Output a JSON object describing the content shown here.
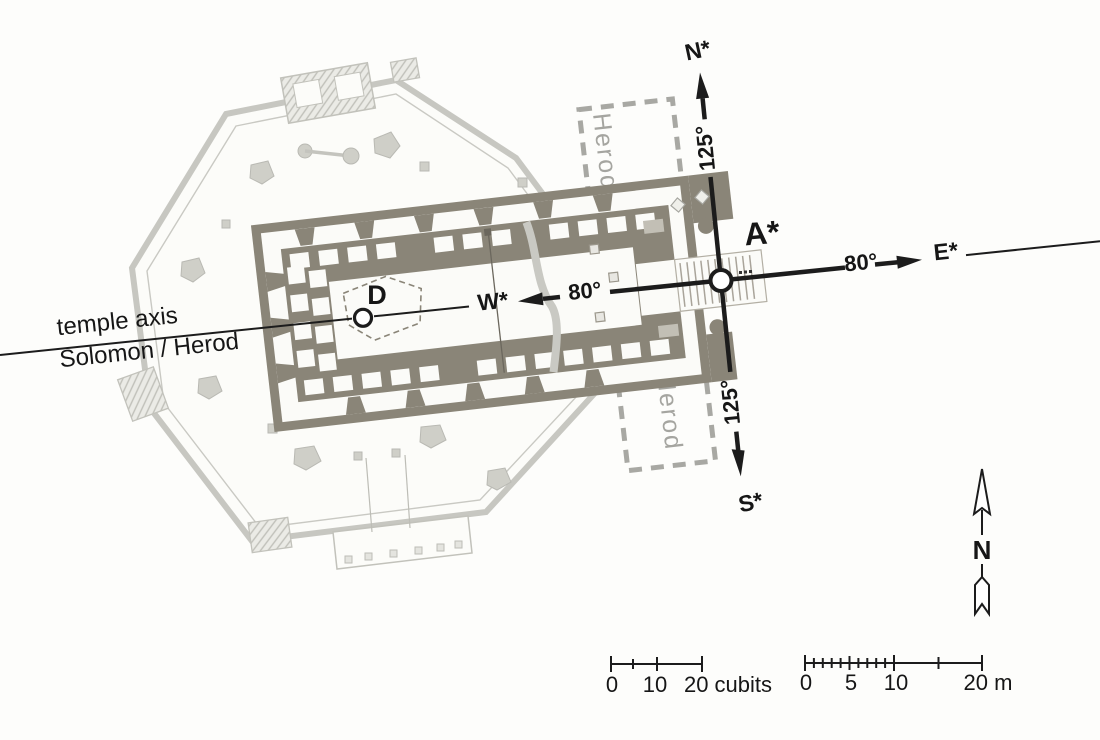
{
  "figure": {
    "axis": {
      "line1": "temple axis",
      "line2": "Solomon / Herod"
    },
    "points": {
      "a": "A*",
      "d": "D"
    },
    "compass": {
      "n": "N*",
      "s": "S*",
      "e": "E*",
      "w": "W*",
      "angle_n": "125°",
      "angle_s": "125°",
      "angle_e": "80°",
      "angle_w": "80°"
    },
    "herod": {
      "upper": "Herod",
      "lower": "Herod"
    },
    "north_indicator": {
      "label": "N"
    },
    "scale_cubits": {
      "t0": "0",
      "t10": "10",
      "t20": "20 cubits"
    },
    "scale_meters": {
      "t0": "0",
      "t5": "5",
      "t10": "10",
      "t20": "20 m"
    },
    "colors": {
      "background": "#fdfdfb",
      "dark_wall": "#8a8578",
      "octagon_gray": "#c7c7c1",
      "dashed_gray": "#a8a8a3",
      "herod_text": "#a5a5a0",
      "ink": "#161616"
    }
  }
}
